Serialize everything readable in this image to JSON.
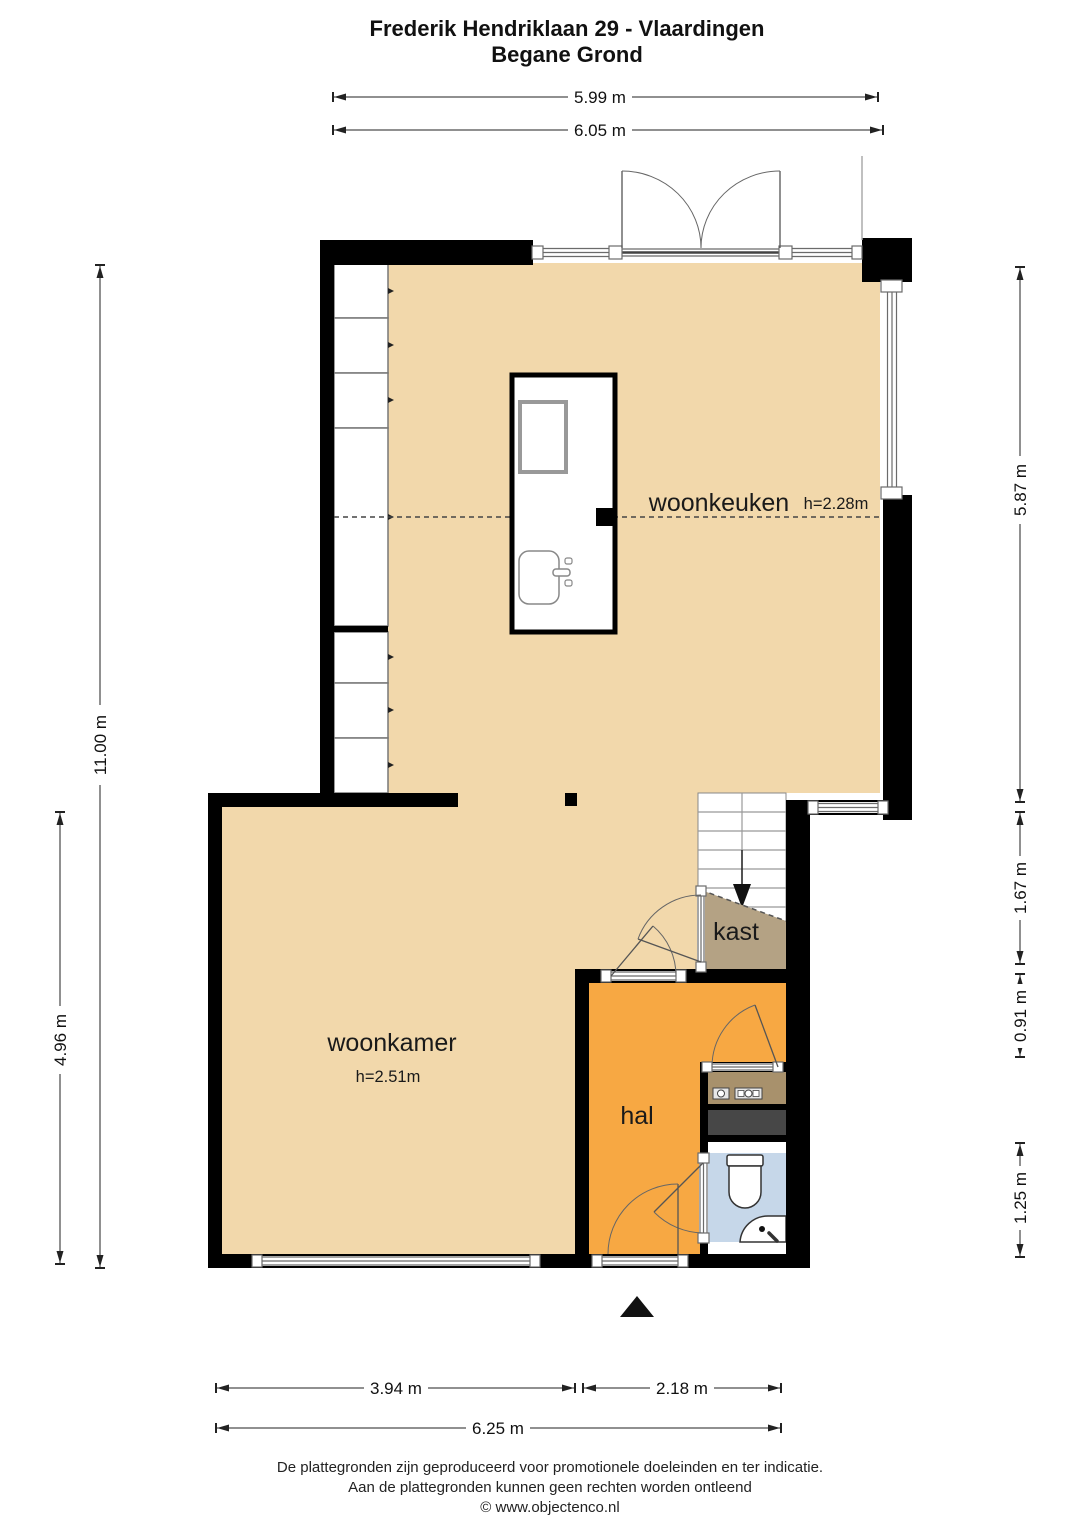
{
  "title": {
    "line1": "Frederik Hendriklaan 29 - Vlaardingen",
    "line2": "Begane Grond"
  },
  "rooms": {
    "woonkeuken": {
      "label": "woonkeuken",
      "height": "h=2.28m"
    },
    "woonkamer": {
      "label": "woonkamer",
      "height": "h=2.51m"
    },
    "hal": {
      "label": "hal"
    },
    "kast": {
      "label": "kast"
    }
  },
  "dims": {
    "top_inner": "5.99 m",
    "top_outer": "6.05 m",
    "left_total": "11.00 m",
    "left_lower": "4.96 m",
    "right_kitchen": "5.87 m",
    "right_stairs": "1.67 m",
    "right_kast": "0.91 m",
    "right_toilet": "1.25 m",
    "bottom_left": "3.94 m",
    "bottom_right": "2.18 m",
    "bottom_total": "6.25 m"
  },
  "footer": {
    "line1": "De plattegronden zijn geproduceerd voor promotionele doeleinden en ter indicatie.",
    "line2": "Aan de plattegronden kunnen geen rechten worden ontleend",
    "line3": "© www.objectenco.nl"
  },
  "colors": {
    "floor": "#f2d8ab",
    "hal": "#f7a843",
    "kast": "#b4a284",
    "meterkast": "#a8916c",
    "shaft": "#474747",
    "toilet": "#c6d7e9",
    "wall": "#000000"
  }
}
